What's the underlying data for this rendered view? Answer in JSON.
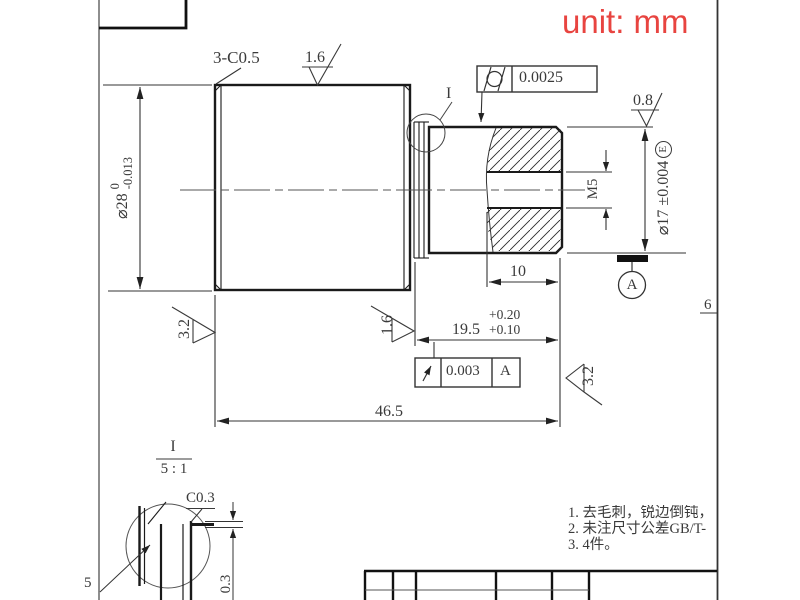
{
  "unit_label": "unit: mm",
  "annotations": {
    "chamfer_note": "3-C0.5",
    "roughness_top": "1.6",
    "roughness_small_end": "0.8",
    "roughness_left": "3.2",
    "roughness_mid": "1.6",
    "roughness_right": "3.2",
    "detail_ref_label": "I",
    "item_number": "5",
    "zone_mark": "6"
  },
  "feature_controls": {
    "cylindricity": {
      "symbol_name": "cylindricity-symbol",
      "value": "0.0025"
    },
    "runout": {
      "symbol_name": "circular-runout-symbol",
      "value": "0.003",
      "datum": "A"
    }
  },
  "datum": {
    "label": "A"
  },
  "dimensions": {
    "dia28": {
      "text": "⌀28",
      "upper": "0",
      "lower": "-0.013"
    },
    "dia17": {
      "text": "⌀17 ±0.004",
      "envelope": "E"
    },
    "thread": "M5",
    "len10": "10",
    "len19_5": {
      "value": "19.5",
      "upper": "+0.20",
      "lower": "+0.10"
    },
    "len46_5": "46.5",
    "detail_step": "0.3",
    "detail_chamfer": "C0.3"
  },
  "detail_view": {
    "label": "I",
    "scale": "5 : 1"
  },
  "notes": [
    "1. 去毛刺，锐边倒钝，",
    "2. 未注尺寸公差GB/T-",
    "3. 4件。"
  ],
  "colors": {
    "unit_text": "#e84440",
    "line": "#222222"
  }
}
